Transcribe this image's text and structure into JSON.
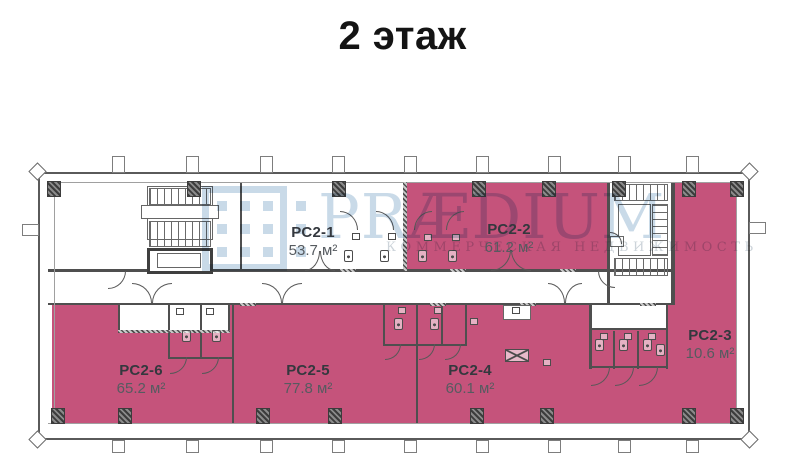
{
  "title": "2 этаж",
  "watermark": {
    "brand": "PRÆDIUM",
    "tagline": "КОММЕРЧЕСКАЯ НЕДВИЖИМОСТЬ"
  },
  "rooms": [
    {
      "id": "PC2-1",
      "area": "53.7 м²",
      "highlighted": false
    },
    {
      "id": "PC2-2",
      "area": "61.2 м²",
      "highlighted": true
    },
    {
      "id": "PC2-3",
      "area": "10.6 м²",
      "highlighted": true
    },
    {
      "id": "PC2-4",
      "area": "60.1 м²",
      "highlighted": true
    },
    {
      "id": "PC2-5",
      "area": "77.8 м²",
      "highlighted": true
    },
    {
      "id": "PC2-6",
      "area": "65.2 м²",
      "highlighted": true
    }
  ],
  "colors": {
    "room_fill": "#c5537b",
    "watermark": "#c9dae8",
    "wall": "#4f4f4f"
  }
}
